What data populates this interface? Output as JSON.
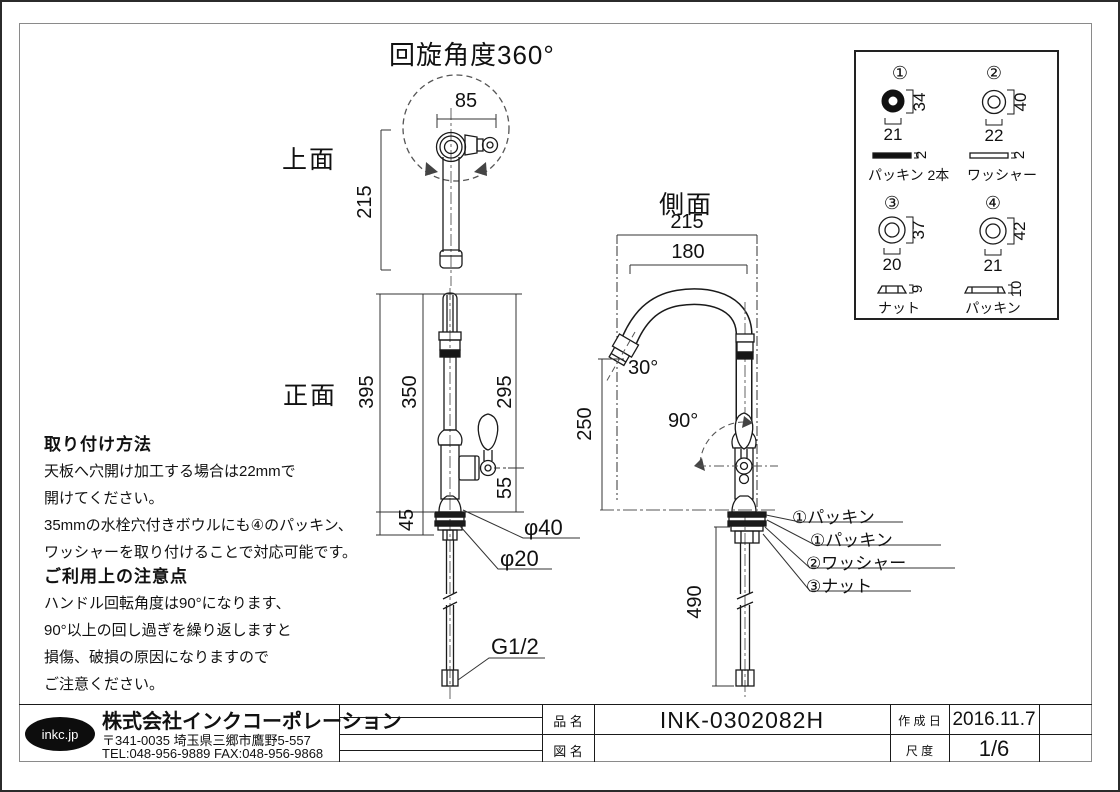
{
  "header": {
    "rotation_note": "回旋角度360°"
  },
  "views": {
    "top": "上面",
    "front": "正面",
    "side": "側面"
  },
  "dims": {
    "top_width": "85",
    "top_depth": "215",
    "front_total": "395",
    "front_above": "350",
    "front_spout": "295",
    "front_handle": "55",
    "front_under": "45",
    "dia40": "φ40",
    "dia20": "φ20",
    "thread": "G1/2",
    "side_depth": "215",
    "side_reach": "180",
    "side_outlet": "250",
    "side_tip_angle": "30°",
    "side_handle_angle": "90°",
    "side_hose": "490"
  },
  "callouts": [
    "①パッキン",
    "①パッキン",
    "②ワッシャー",
    "③ナット"
  ],
  "parts_table": {
    "items": [
      {
        "no": "①",
        "od": "34",
        "id": "21",
        "t": "2",
        "name": "パッキン 2本"
      },
      {
        "no": "②",
        "od": "40",
        "id": "22",
        "t": "2",
        "name": "ワッシャー"
      },
      {
        "no": "③",
        "od": "37",
        "id": "20",
        "t": "9",
        "name": "ナット"
      },
      {
        "no": "④",
        "od": "42",
        "id": "21",
        "t": "10",
        "name": "パッキン"
      }
    ]
  },
  "notes_install": {
    "title": "取り付け方法",
    "lines": [
      "天板へ穴開け加工する場合は22mmで",
      "開けてください。",
      "35mmの水栓穴付きボウルにも④のパッキン、",
      "ワッシャーを取り付けることで対応可能です。"
    ]
  },
  "notes_caution": {
    "title": "ご利用上の注意点",
    "lines": [
      "ハンドル回転角度は90°になります、",
      "90°以上の回し過ぎを繰り返しますと",
      "損傷、破損の原因になりますので",
      "ご注意ください。"
    ]
  },
  "company": {
    "logo": "inkc.jp",
    "name": "株式会社インクコーポレーション",
    "address": "〒341-0035 埼玉県三郷市鷹野5-557",
    "contact": "TEL:048-956-9889  FAX:048-956-9868"
  },
  "title_block": {
    "product_label": "品 名",
    "product_value": "INK-0302082H",
    "drawing_label": "図 名",
    "drawing_value": "",
    "date_label": "作 成 日",
    "date_value": "2016.11.7",
    "scale_label": "尺 度",
    "scale_value": "1/6"
  }
}
